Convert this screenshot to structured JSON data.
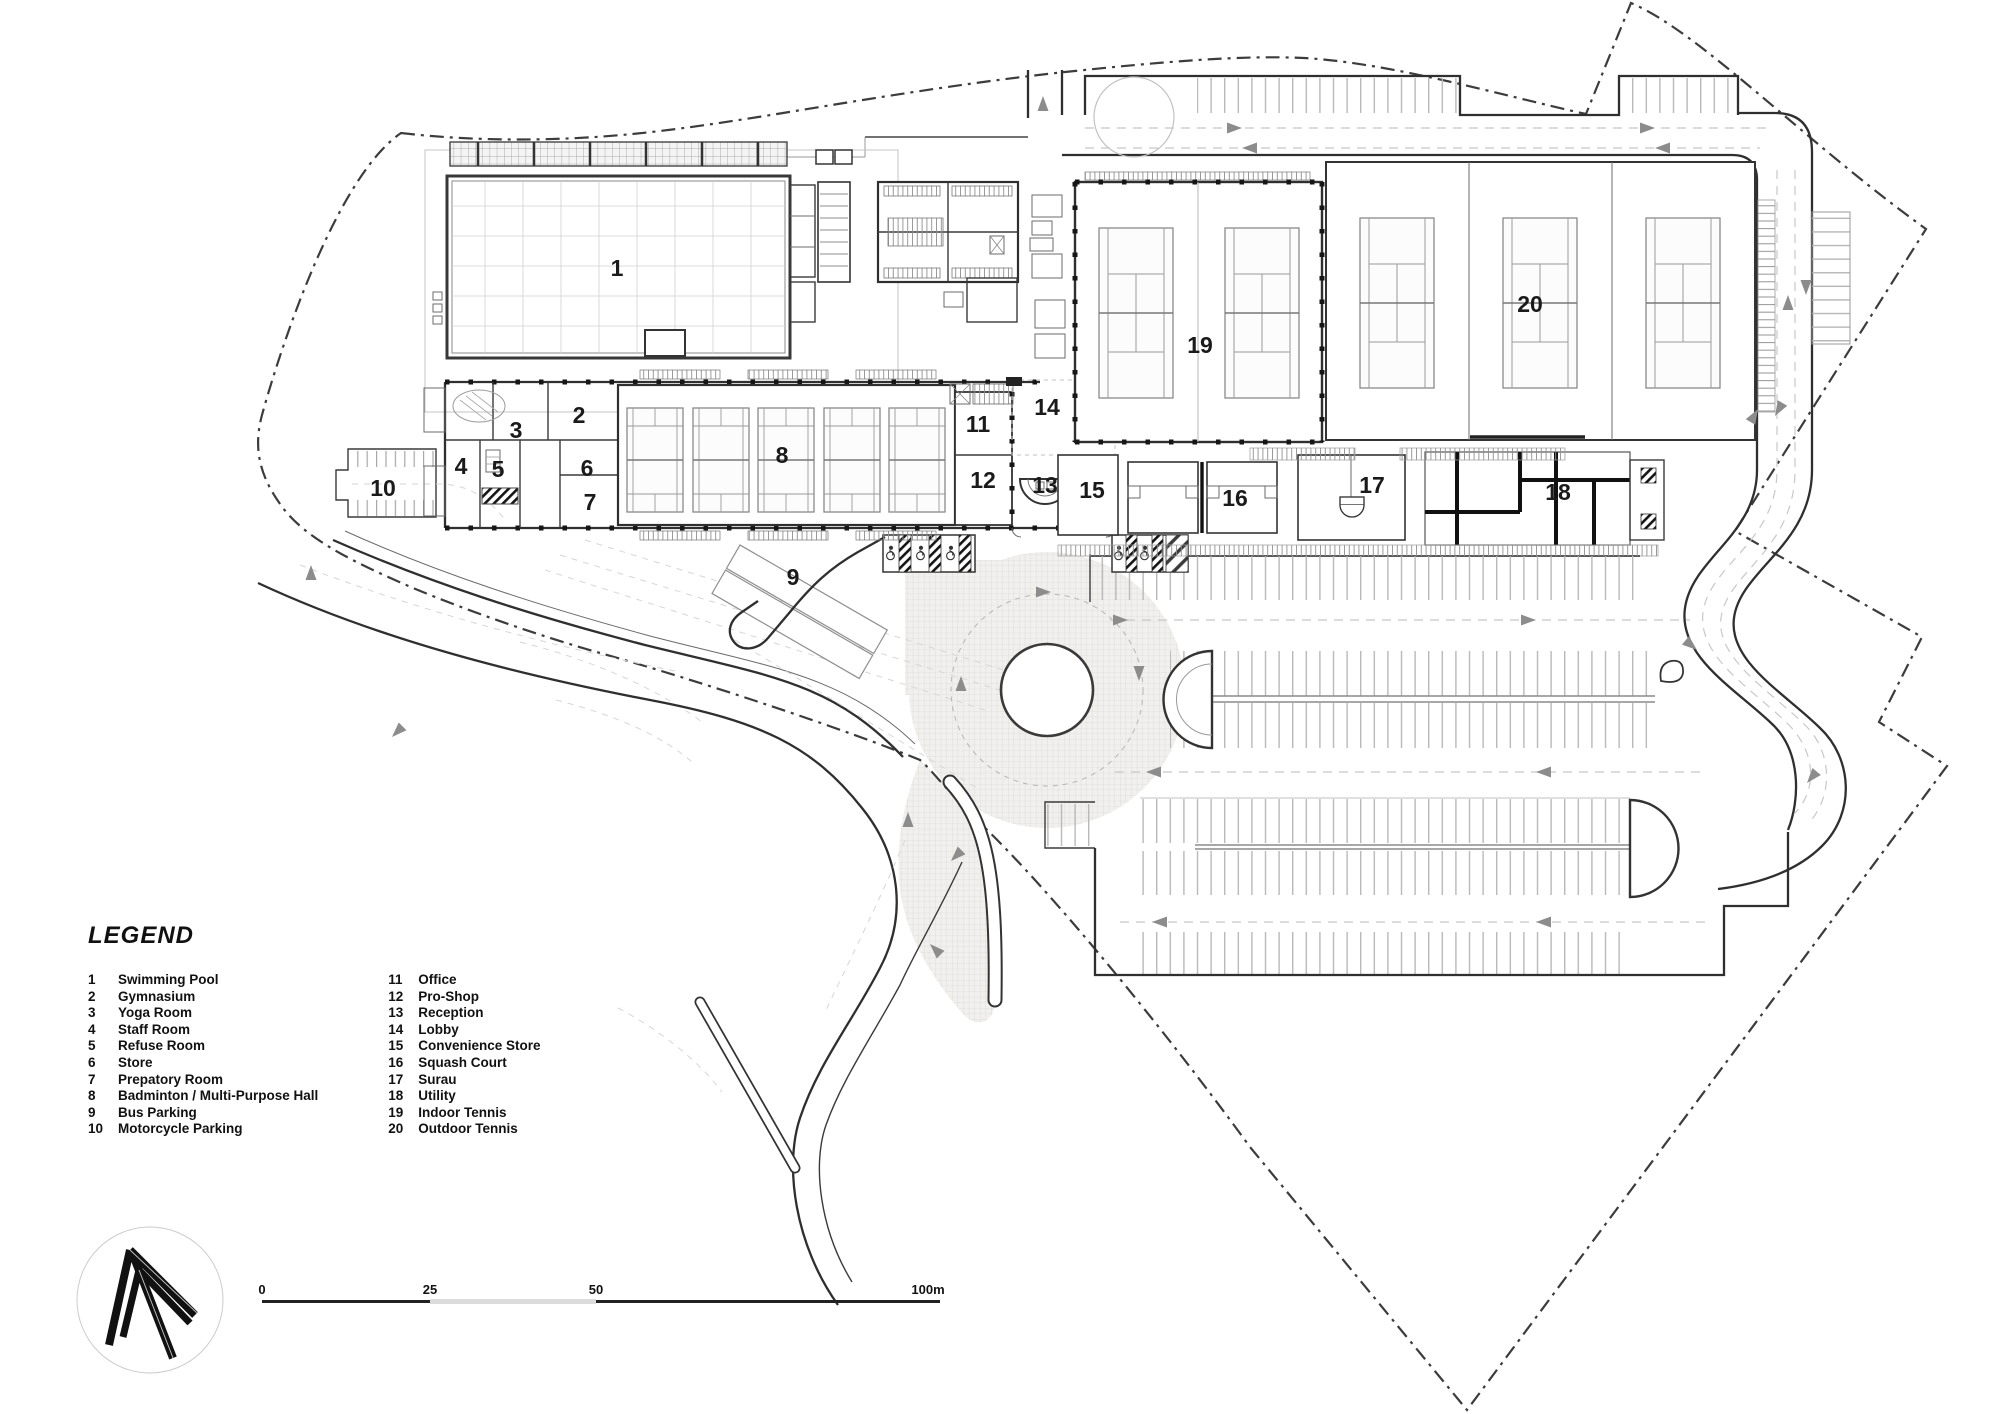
{
  "legend": {
    "title": "LEGEND",
    "columns": [
      [
        {
          "num": "1",
          "label": "Swimming Pool"
        },
        {
          "num": "2",
          "label": "Gymnasium"
        },
        {
          "num": "3",
          "label": "Yoga Room"
        },
        {
          "num": "4",
          "label": "Staff Room"
        },
        {
          "num": "5",
          "label": "Refuse Room"
        },
        {
          "num": "6",
          "label": "Store"
        },
        {
          "num": "7",
          "label": "Prepatory Room"
        },
        {
          "num": "8",
          "label": "Badminton / Multi-Purpose Hall"
        },
        {
          "num": "9",
          "label": "Bus Parking"
        },
        {
          "num": "10",
          "label": "Motorcycle Parking"
        }
      ],
      [
        {
          "num": "11",
          "label": "Office"
        },
        {
          "num": "12",
          "label": "Pro-Shop"
        },
        {
          "num": "13",
          "label": "Reception"
        },
        {
          "num": "14",
          "label": "Lobby"
        },
        {
          "num": "15",
          "label": "Convenience Store"
        },
        {
          "num": "16",
          "label": "Squash Court"
        },
        {
          "num": "17",
          "label": "Surau"
        },
        {
          "num": "18",
          "label": "Utility"
        },
        {
          "num": "19",
          "label": "Indoor Tennis"
        },
        {
          "num": "20",
          "label": "Outdoor Tennis"
        }
      ]
    ]
  },
  "scale_bar": {
    "ticks": [
      "0",
      "25",
      "50",
      "100m"
    ]
  },
  "colors": {
    "wall": "#2f2f2f",
    "boundary": "#3c3c3c",
    "arrow": "#8c8c8c",
    "paving": "#f1f0ee"
  }
}
